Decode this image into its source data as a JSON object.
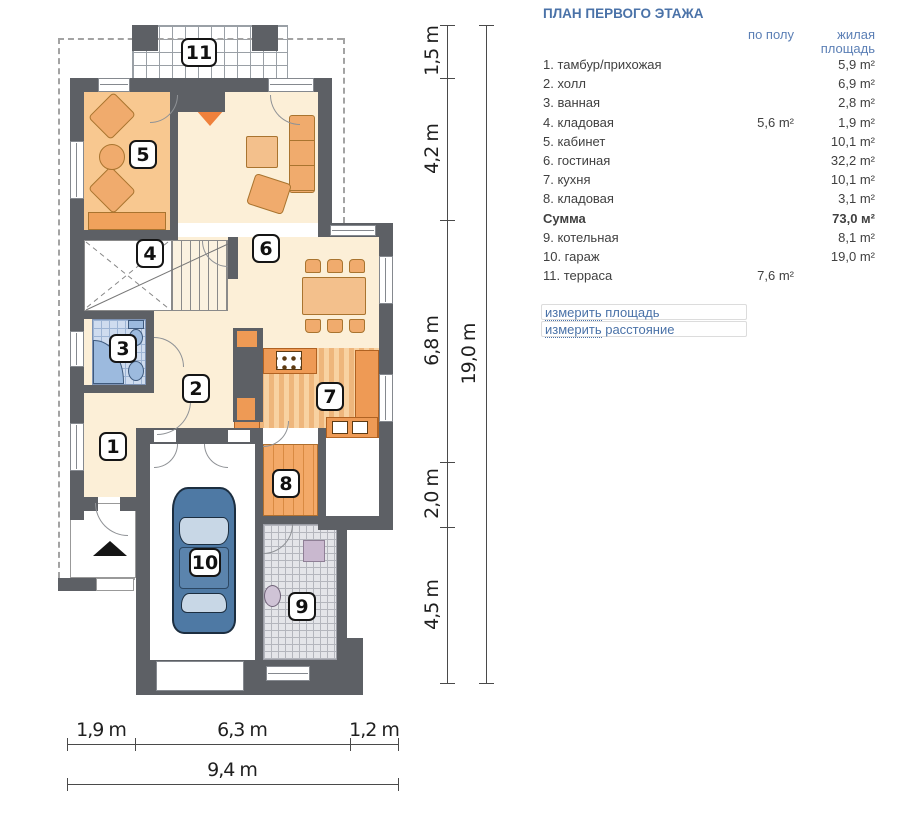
{
  "legend": {
    "title": "ПЛАН ПЕРВОГО ЭТАЖА",
    "col_floor": "по полу",
    "col_living_1": "жилая",
    "col_living_2": "площадь",
    "rows": [
      {
        "label": "1. тамбур/прихожая",
        "floor": "",
        "living": "5,9 m²"
      },
      {
        "label": "2. холл",
        "floor": "",
        "living": "6,9 m²"
      },
      {
        "label": "3. ванная",
        "floor": "",
        "living": "2,8 m²"
      },
      {
        "label": "4. кладовая",
        "floor": "5,6 m²",
        "living": "1,9 m²"
      },
      {
        "label": "5. кабинет",
        "floor": "",
        "living": "10,1 m²"
      },
      {
        "label": "6. гостиная",
        "floor": "",
        "living": "32,2 m²"
      },
      {
        "label": "7. кухня",
        "floor": "",
        "living": "10,1 m²"
      },
      {
        "label": "8. кладовая",
        "floor": "",
        "living": "3,1 m²"
      },
      {
        "label": "Сумма",
        "floor": "",
        "living": "73,0 м²"
      },
      {
        "label": "9. котельная",
        "floor": "",
        "living": "8,1 m²"
      },
      {
        "label": "10. гараж",
        "floor": "",
        "living": "19,0 m²"
      },
      {
        "label": "11. терраса",
        "floor": "7,6 m²",
        "living": ""
      }
    ],
    "links": [
      {
        "w1": "измерить",
        "w2": " площадь"
      },
      {
        "w1": "измерить",
        "w2": " расстояние"
      }
    ]
  },
  "dims": {
    "vertical": [
      "1,5 m",
      "4,2 m",
      "6,8 m",
      "2,0 m",
      "4,5 m"
    ],
    "vertical_total": "19,0 m",
    "horizontal": [
      "1,9 m",
      "6,3 m",
      "1,2 m"
    ],
    "horizontal_total": "9,4 m"
  },
  "plan": {
    "badges": [
      "1",
      "2",
      "3",
      "4",
      "5",
      "6",
      "7",
      "8",
      "9",
      "10",
      "11"
    ]
  },
  "colors": {
    "accent_blue": "#4a72a8",
    "wall_gray": "#5d6065",
    "floor_cream": "#fcefd7",
    "room5_orange": "#f8c890",
    "furniture_orange": "#f0ab6d",
    "counter_orange": "#ee9a55",
    "fireplace_orange": "#ef813c",
    "fixture_blue": "#9cbade",
    "car_blue": "#4e79a4",
    "bath_tile": "#cfdcef",
    "boiler_tile": "#e4e5e9"
  }
}
